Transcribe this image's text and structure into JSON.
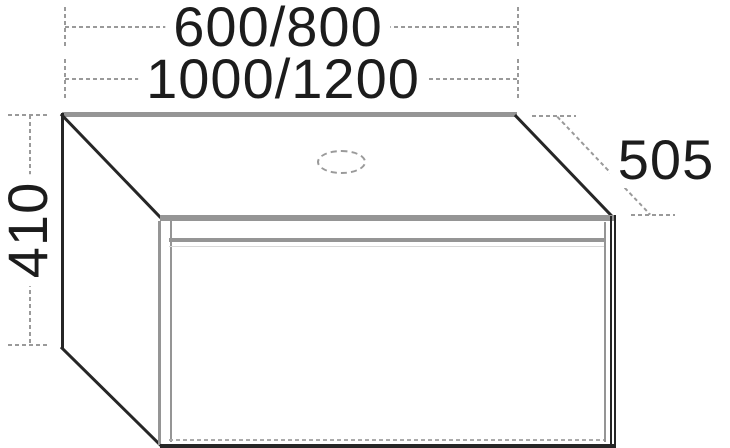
{
  "dimensions": {
    "top_width": "600/800",
    "bottom_width": "1000/1200",
    "height": "410",
    "depth": "505"
  },
  "icons": {
    "tap_hole": "dashed-ellipse-cutout"
  },
  "colors": {
    "line_dark": "#262626",
    "line_gray": "#959595",
    "line_light": "#ababab",
    "dimension_gray": "#9a9a9a",
    "text": "#1c1c1c",
    "background": "#ffffff"
  }
}
